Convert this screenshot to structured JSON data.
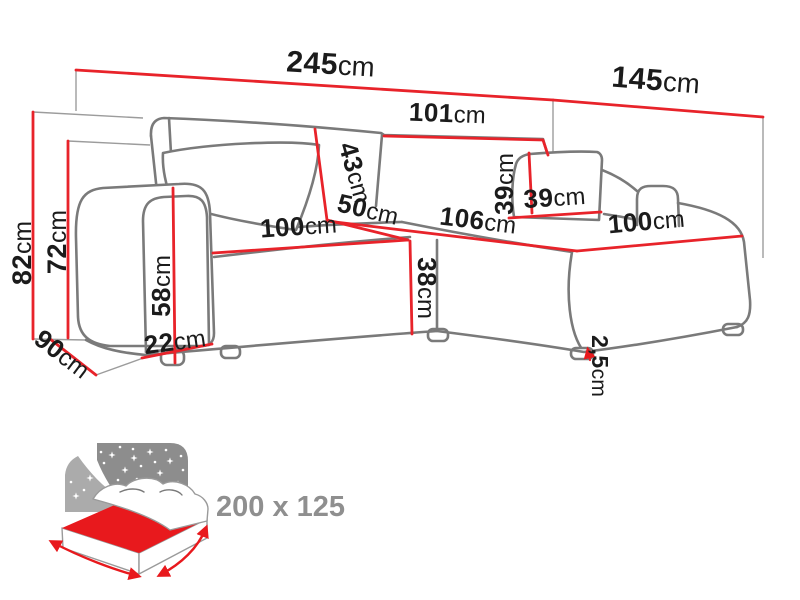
{
  "diagram": {
    "type": "corner-sofa-dimension-diagram",
    "unit": "cm",
    "colors": {
      "dimension_line": "#e8232a",
      "sofa_outline": "#7a7a7a",
      "projection_line": "#9c9c9c",
      "label_text": "#1b1b1b",
      "icon_dark_gray": "#8d8d8d",
      "icon_light_gray": "#ababab",
      "icon_red": "#e8191d",
      "icon_text": "#8f8f8f",
      "background": "#ffffff"
    },
    "dimensions": [
      {
        "id": "total-width",
        "value": "245",
        "x": 330,
        "y": 74,
        "r": 3.5,
        "s": 30
      },
      {
        "id": "chaise-total-depth",
        "value": "145",
        "x": 655,
        "y": 90,
        "r": 4.5,
        "s": 30
      },
      {
        "id": "right-backrest-width",
        "value": "101",
        "x": 447,
        "y": 122,
        "r": 2,
        "s": 26
      },
      {
        "id": "total-height",
        "value": "82",
        "x": 31,
        "y": 253,
        "r": -90,
        "s": 27
      },
      {
        "id": "backrest-height",
        "value": "72",
        "x": 66,
        "y": 242,
        "r": -90,
        "s": 27
      },
      {
        "id": "armrest-height",
        "value": "58",
        "x": 170,
        "y": 286,
        "r": -90,
        "s": 26
      },
      {
        "id": "armrest-width",
        "value": "22",
        "x": 176,
        "y": 350,
        "r": -8,
        "s": 26
      },
      {
        "id": "side-depth",
        "value": "90",
        "x": 57,
        "y": 361,
        "r": 37,
        "s": 26
      },
      {
        "id": "backrest-cushion-height",
        "value": "43",
        "x": 347,
        "y": 175,
        "r": 74,
        "s": 26
      },
      {
        "id": "seat-split",
        "value": "50",
        "x": 366,
        "y": 218,
        "r": 13,
        "s": 26
      },
      {
        "id": "left-seat-width",
        "value": "100",
        "x": 299,
        "y": 235,
        "r": -4,
        "s": 26
      },
      {
        "id": "chaise-seat-depth",
        "value": "106",
        "x": 477,
        "y": 229,
        "r": 7,
        "s": 26
      },
      {
        "id": "right-seat-width",
        "value": "100",
        "x": 647,
        "y": 230,
        "r": -5,
        "s": 26
      },
      {
        "id": "pillow-height",
        "value": "39",
        "x": 513,
        "y": 184,
        "r": -90,
        "s": 26
      },
      {
        "id": "pillow-width",
        "value": "39",
        "x": 555,
        "y": 206,
        "r": -4,
        "s": 26
      },
      {
        "id": "seat-height",
        "value": "38",
        "x": 418,
        "y": 288,
        "r": 90,
        "s": 26
      },
      {
        "id": "leg-height",
        "value": "2,5",
        "x": 592,
        "y": 366,
        "r": 90,
        "s": 23
      }
    ],
    "sleep_function": {
      "label": "200 x 125"
    }
  }
}
